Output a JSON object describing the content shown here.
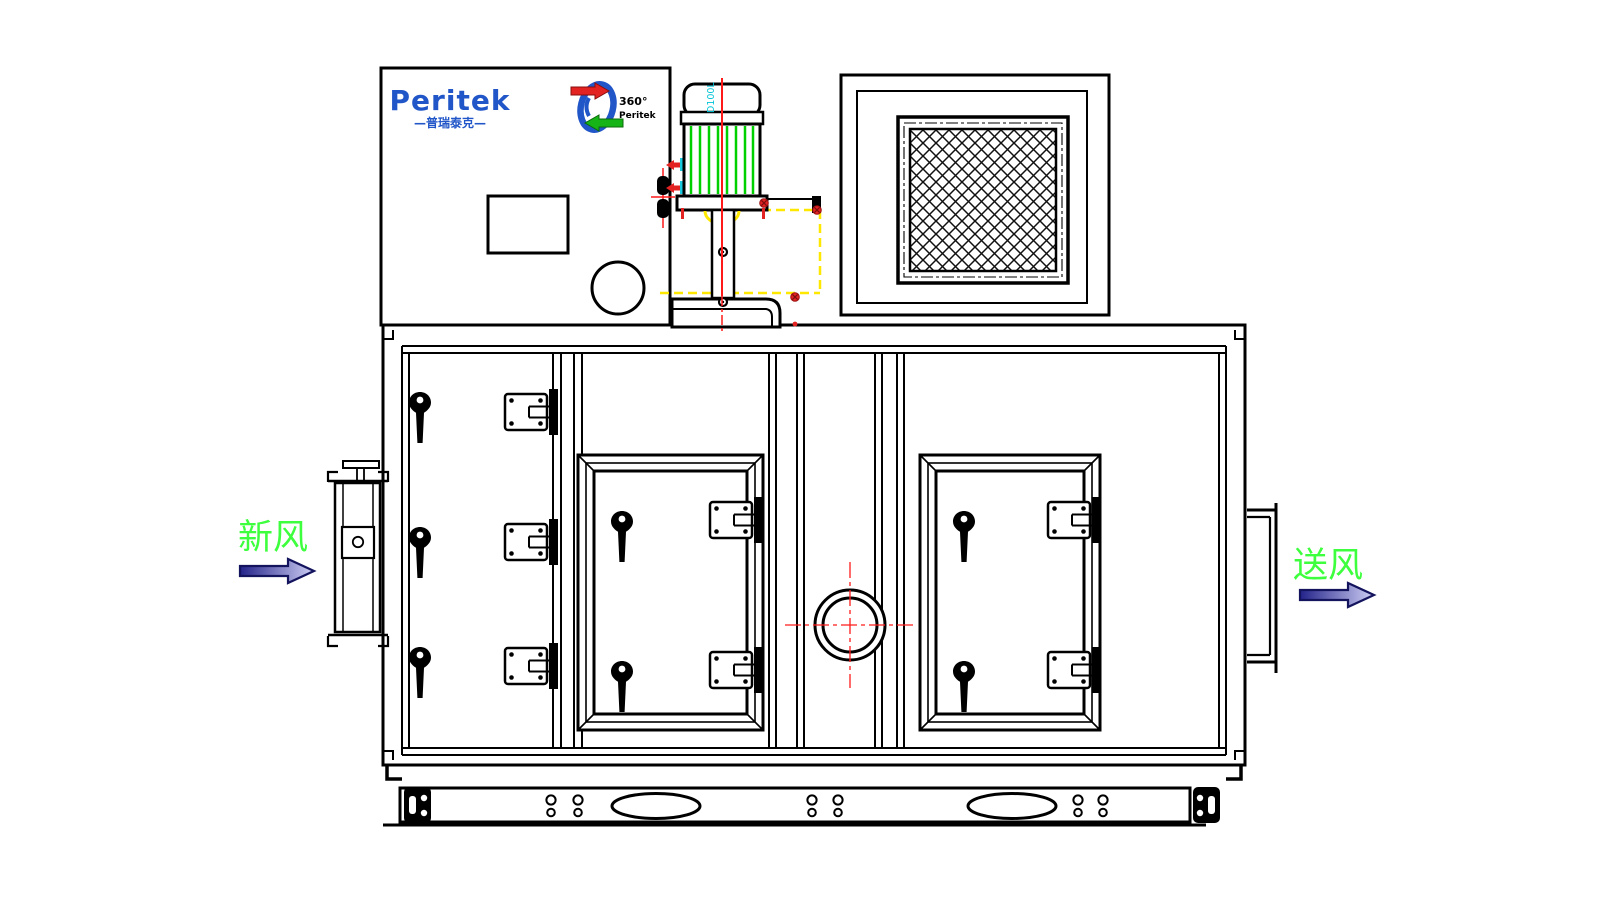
{
  "document": {
    "type": "engineering-drawing",
    "subject": "Peritek desiccant dehumidifier unit — front elevation"
  },
  "branding": {
    "logo_text": "Peritek",
    "logo_subtext": "—普瑞泰克—",
    "rotor_mark_line1": "360°",
    "rotor_mark_line2": "Peritek"
  },
  "motor": {
    "frame_label": "D100L"
  },
  "flow": {
    "inlet_label": "新风",
    "outlet_label": "送风"
  },
  "colors": {
    "line_black": "#000000",
    "brand_blue": "#2156c8",
    "flow_label_green": "#3dff3d",
    "fin_green": "#00d000",
    "centerline_red": "#ff1a1a",
    "bolt_red": "#e32222",
    "damper_yellow": "#ffe800",
    "motor_label_cyan": "#00c4d8",
    "arrow_gradient_start": "#23238a",
    "arrow_gradient_end": "#cfcff5",
    "arrow_outline": "#14145e"
  }
}
